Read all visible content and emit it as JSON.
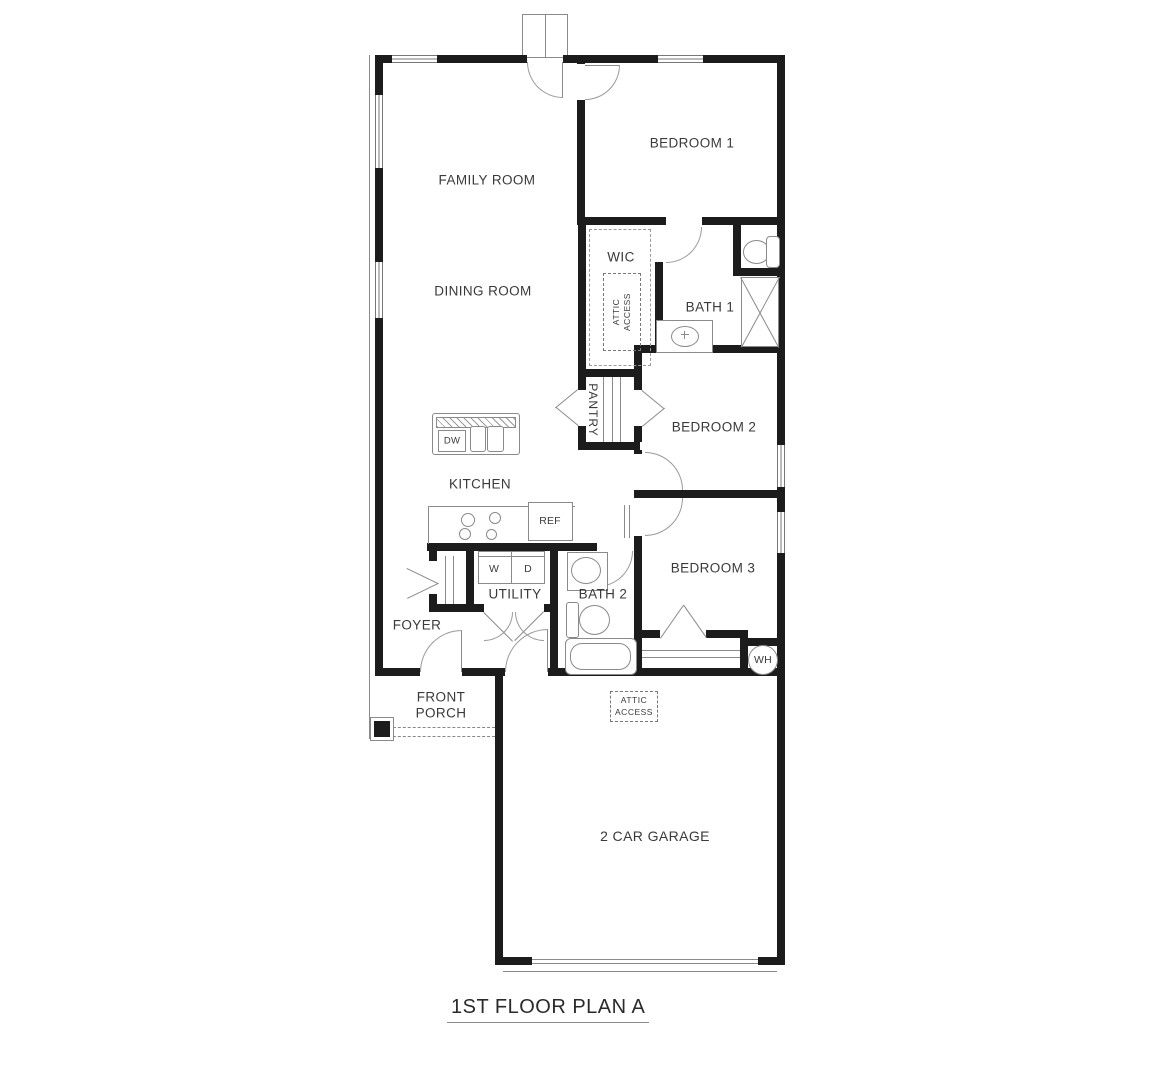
{
  "title": "1ST FLOOR PLAN A",
  "colors": {
    "wall": "#1c1c1c",
    "fixture_line": "#8a8a8a",
    "text": "#3a3a3a"
  },
  "rooms": {
    "family_room": "FAMILY ROOM",
    "dining_room": "DINING ROOM",
    "kitchen": "KITCHEN",
    "bedroom_1": "BEDROOM 1",
    "bedroom_2": "BEDROOM 2",
    "bedroom_3": "BEDROOM 3",
    "wic": "WIC",
    "bath_1": "BATH 1",
    "bath_2": "BATH 2",
    "pantry": "PANTRY",
    "utility": "UTILITY",
    "foyer": "FOYER",
    "front_porch_line1": "FRONT",
    "front_porch_line2": "PORCH",
    "garage": "2 CAR GARAGE"
  },
  "labels": {
    "water_heater": "WH",
    "attic_access_line1": "ATTIC",
    "attic_access_line2": "ACCESS"
  },
  "appliances": {
    "dishwasher": "DW",
    "refrigerator": "REF",
    "washer": "W",
    "dryer": "D"
  }
}
